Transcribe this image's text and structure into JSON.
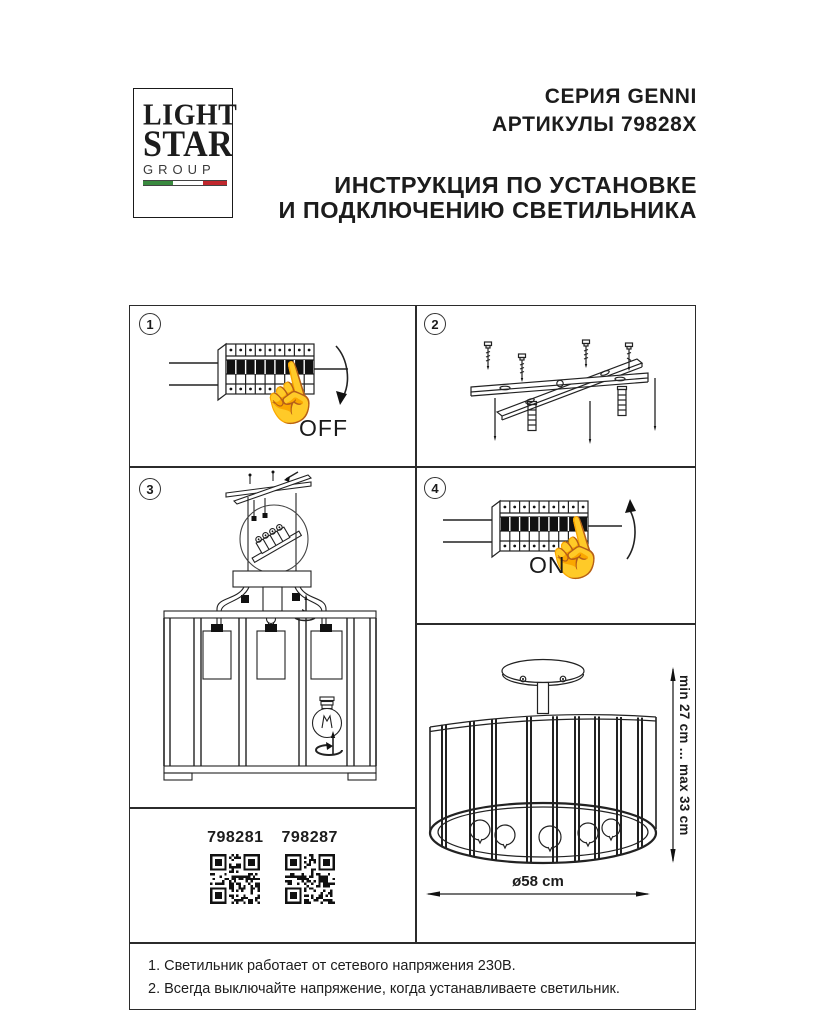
{
  "header": {
    "logo": {
      "line1": "LIGHT",
      "line2": "STAR",
      "line3": "GROUP"
    },
    "series": "СЕРИЯ GENNI",
    "articles": "АРТИКУЛЫ 79828X",
    "instruction_line1": "ИНСТРУКЦИЯ ПО УСТАНОВКЕ",
    "instruction_line2": "И ПОДКЛЮЧЕНИЮ СВЕТИЛЬНИКА"
  },
  "steps": {
    "step1": {
      "number": "1",
      "label": "OFF"
    },
    "step2": {
      "number": "2"
    },
    "step3": {
      "number": "3"
    },
    "step4": {
      "number": "4",
      "label": "ON"
    }
  },
  "qr_codes": [
    {
      "label": "798281"
    },
    {
      "label": "798287"
    }
  ],
  "dimensions": {
    "height_range": "min 27 cm ... max 33 cm",
    "diameter": "ø58 cm"
  },
  "notes": [
    "1. Светильник работает от сетевого напряжения 230В.",
    "2. Всегда выключайте напряжение, когда устанавливаете светильник."
  ],
  "icons": {
    "pointing_hand": "☝"
  },
  "colors": {
    "ink": "#1c1c1c",
    "flag_green": "#3a8a3f",
    "flag_red": "#c0272d"
  }
}
